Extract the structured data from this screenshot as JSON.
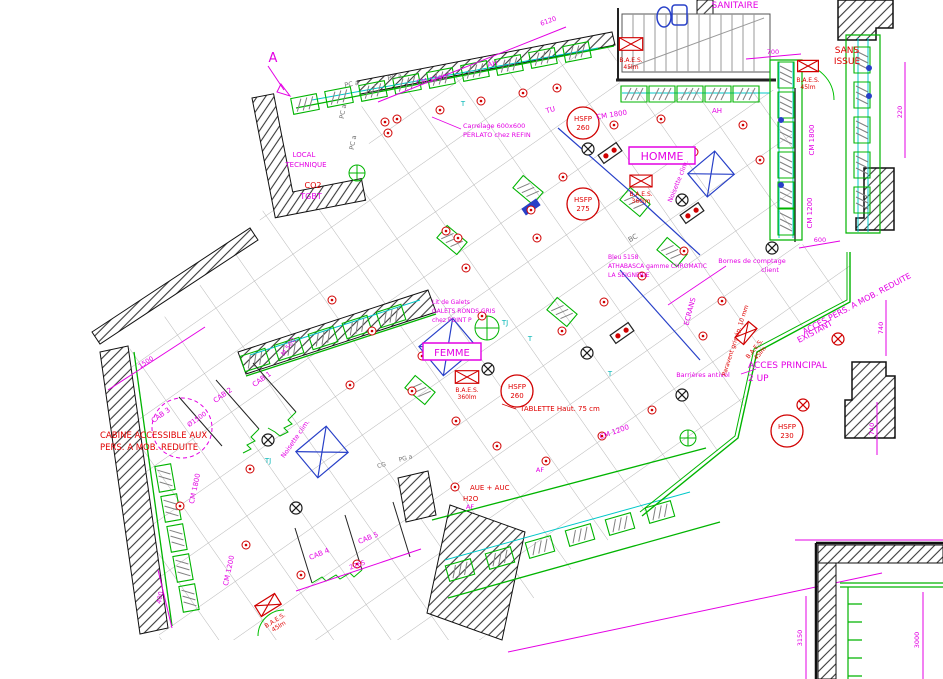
{
  "zones": {
    "sanitaire": "SANITAIRE",
    "sans_issue_1": "SANS",
    "sans_issue_2": "ISSUE",
    "homme": "HOMME",
    "femme": "FEMME",
    "local_1": "LOCAL",
    "local_2": "TECHNIQUE",
    "co2": "CO2",
    "tgbt": "TGBT",
    "acces_principal_1": "ACCES PRINCIPAL",
    "acces_principal_2": "2 UP",
    "acces_pers_1": "ACCES PERS. A MOB. REDUITE",
    "acces_pers_2": "EXISTANT",
    "cabine_1": "CABINE ACCESSIBLE AUX",
    "cabine_2": "PERS. A MOB. REDUITE"
  },
  "safety": {
    "baes": "B.A.E.S.",
    "lm_45": "45lm",
    "lm_360": "360lm",
    "hsfp": "HSFP",
    "hsfp_260": "260",
    "hsfp_275": "275",
    "hsfp_230": "230"
  },
  "fixtures": {
    "cm_1200": "CM 1200",
    "cm_1800": "CM 1800",
    "m_500": "M 500",
    "pc_a": "PC a",
    "pg_a": "PG a",
    "cg": "CG",
    "ah": "AH",
    "bc": "BC",
    "tj": "TJ",
    "tu": "TU",
    "t": "T",
    "af": "AF",
    "ecrans": "ECRANS",
    "noisette": "Noisette clim.",
    "barrieres": "Barrières antivol",
    "tablette": "TABLETTE Haut. 75 cm",
    "bornes_1": "Bornes de comptage",
    "bornes_2": "client",
    "aue": "AUE + AUC",
    "h2o": "H2O",
    "paravent": "Paravent gris ép. 10 mm",
    "cab_1": "CAB 1",
    "cab_2": "CAB 2",
    "cab_3": "CAB 3",
    "cab_4": "CAB 4",
    "cab_5": "CAB 5",
    "diam": "Ø1500"
  },
  "notes": {
    "carrelage_1": "Carrelage 600x600",
    "carrelage_2": "PERLATO chez REFIN",
    "galets_1": "Lit de Galets",
    "galets_2": "GALETS RONDS GRIS",
    "galets_3": "chez POINT P",
    "bleu_1": "Bleu 5158",
    "bleu_2": "ATHABASCA gamme CHROMATIC",
    "bleu_3": "LA SEIGNERIE"
  },
  "dims": {
    "d6120": "6120",
    "d700": "700",
    "d220": "220",
    "d600": "600",
    "d740": "740",
    "d2265": "2265",
    "d1500": "1500",
    "d400": "400",
    "d3150": "3150",
    "d3000": "3000"
  },
  "markers": {
    "section_a": "A"
  },
  "colors": {
    "annotation_magenta": "#e400e4",
    "safety_red": "#e00000",
    "fixture_green": "#00b400",
    "rail_cyan": "#00c8c8",
    "equipment_blue": "#2840c8",
    "grid_gray": "#b8b8b8"
  }
}
